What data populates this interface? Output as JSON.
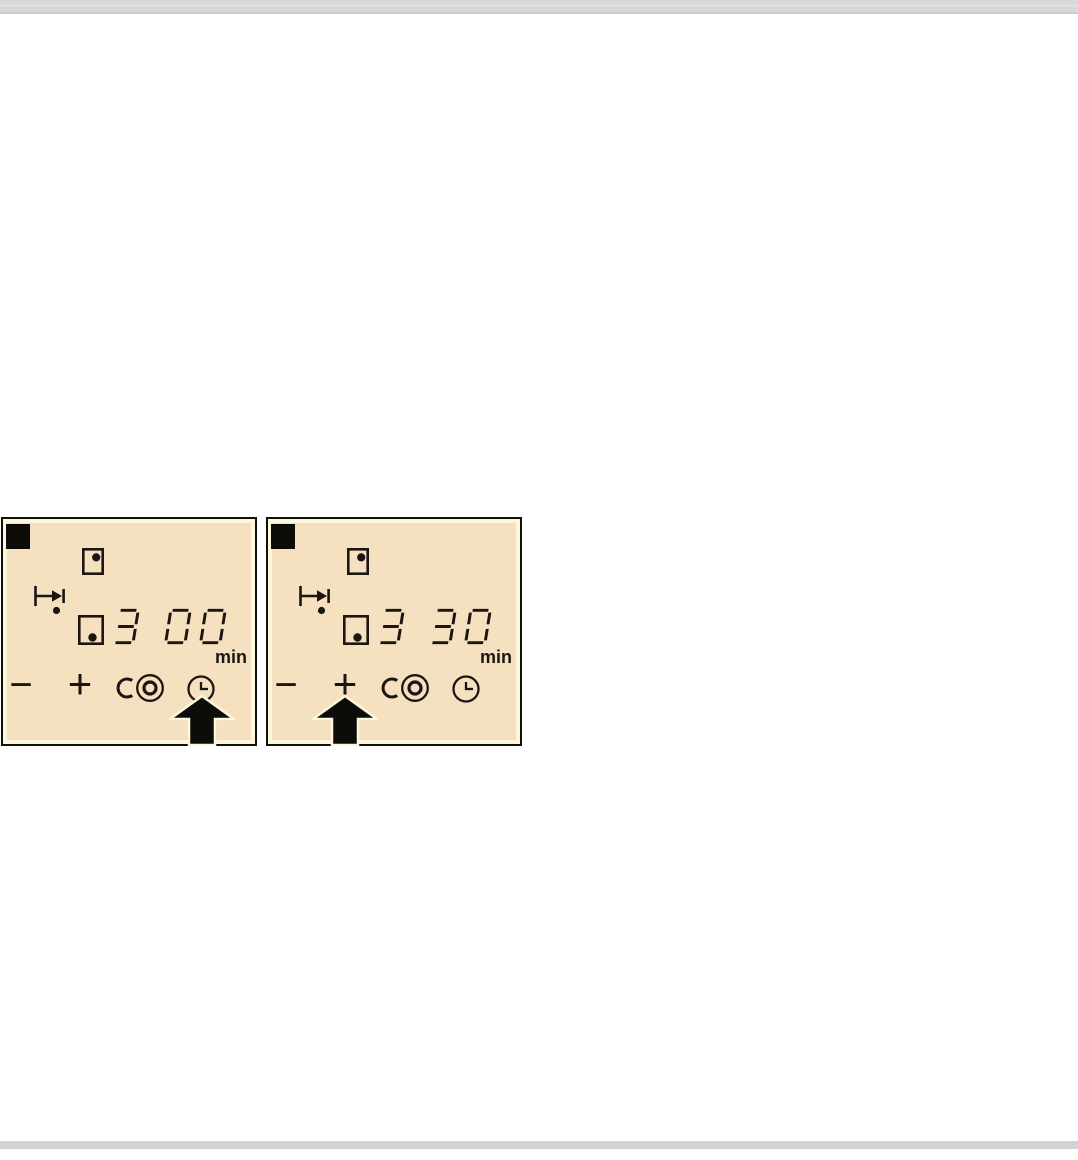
{
  "colors": {
    "page_bg": "#ffffff",
    "divider_bar_gray": "#d5d5d5",
    "panel_background": "#f5e1bf",
    "panel_frame_cream": "#fdf8dd",
    "panel_outline": "#111009",
    "glyph_ink": "#1b1613"
  },
  "panels": [
    {
      "display_value": "3 00",
      "unit": "min",
      "controls": {
        "minus": "−",
        "plus": "+"
      },
      "icons": {
        "step_marker": "black-square-marker",
        "rear_zone": "square-with-dot-top-right",
        "timer_assign": "arrow-to-bar-with-dot",
        "front_zone": "square-with-dot-bottom-right",
        "dual_zone": "c-with-double-circle",
        "timer": "clock"
      },
      "arrow_points_at": "timer-button"
    },
    {
      "display_value": "3 30",
      "unit": "min",
      "controls": {
        "minus": "−",
        "plus": "+"
      },
      "icons": {
        "step_marker": "black-square-marker",
        "rear_zone": "square-with-dot-top-right",
        "timer_assign": "arrow-to-bar-with-dot",
        "front_zone": "square-with-dot-bottom-right",
        "dual_zone": "c-with-double-circle",
        "timer": "clock"
      },
      "arrow_points_at": "plus-button"
    }
  ]
}
